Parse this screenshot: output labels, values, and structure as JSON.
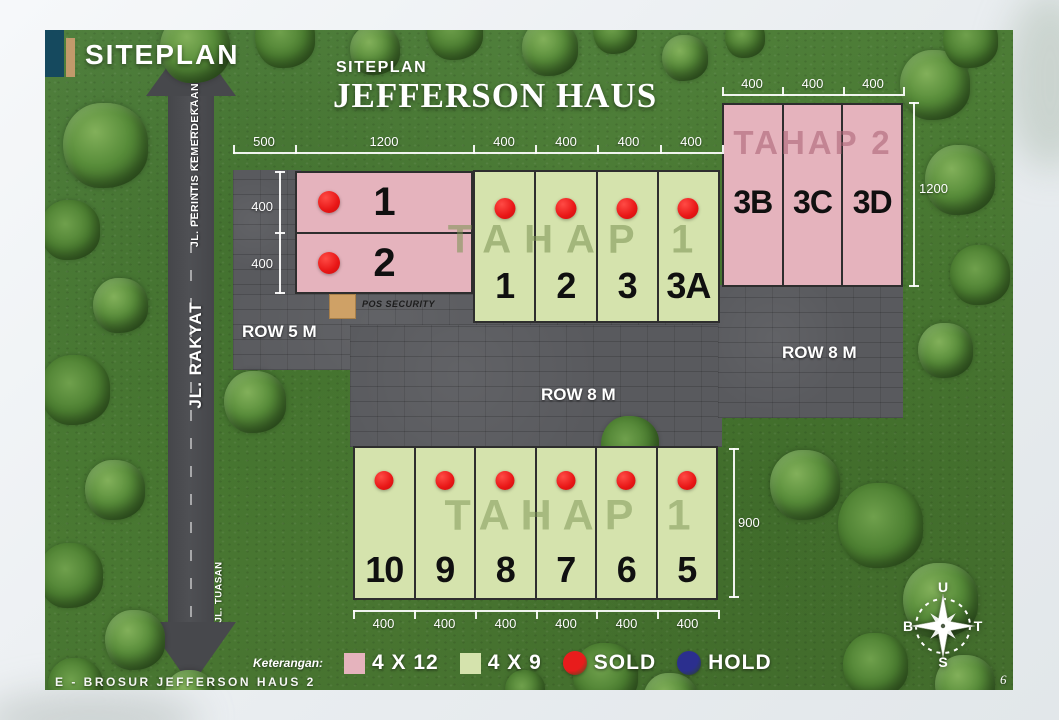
{
  "header": {
    "brand": "SITEPLAN"
  },
  "title": {
    "eyebrow": "SITEPLAN",
    "main": "JEFFERSON HAUS"
  },
  "watermarks": {
    "phase1_north": "TAHAP 1",
    "phase2": "TAHAP 2",
    "phase1_south": "TAHAP 1"
  },
  "streets": {
    "north": "JL. PERINTIS KEMERDEKAAN",
    "west": "JL. RAKYAT",
    "south": "JL. TUASAN"
  },
  "row_labels": {
    "row5": "ROW 5 M",
    "row8_east": "ROW 8 M",
    "row8_center": "ROW 8 M"
  },
  "security_post": {
    "label": "POS SECURITY"
  },
  "blocks": {
    "pink_north": {
      "lots": [
        {
          "label": "1",
          "status": "sold"
        },
        {
          "label": "2",
          "status": "sold"
        }
      ]
    },
    "green_north": {
      "lots": [
        {
          "label": "1",
          "status": "sold"
        },
        {
          "label": "2",
          "status": "sold"
        },
        {
          "label": "3",
          "status": "sold"
        },
        {
          "label": "3A",
          "status": "sold"
        }
      ]
    },
    "pink_east": {
      "lots": [
        {
          "label": "3B",
          "status": "available"
        },
        {
          "label": "3C",
          "status": "available"
        },
        {
          "label": "3D",
          "status": "available"
        }
      ]
    },
    "green_south": {
      "lots": [
        {
          "label": "10",
          "status": "sold"
        },
        {
          "label": "9",
          "status": "sold"
        },
        {
          "label": "8",
          "status": "sold"
        },
        {
          "label": "7",
          "status": "sold"
        },
        {
          "label": "6",
          "status": "sold"
        },
        {
          "label": "5",
          "status": "sold"
        }
      ]
    }
  },
  "dimensions": {
    "north_top": [
      "500",
      "1200",
      "400",
      "400",
      "400",
      "400"
    ],
    "east_top": [
      "400",
      "400",
      "400"
    ],
    "east_right": "1200",
    "west_side": [
      "400",
      "400"
    ],
    "south_right": "900",
    "south_bottom": [
      "400",
      "400",
      "400",
      "400",
      "400",
      "400"
    ]
  },
  "legend": {
    "title": "Keterangan:",
    "items": [
      {
        "type": "swatch",
        "color": "#e5b3bd",
        "label": "4 X 12"
      },
      {
        "type": "swatch",
        "color": "#d5e3ad",
        "label": "4 X 9"
      },
      {
        "type": "dot",
        "color": "#e81c1c",
        "label": "SOLD"
      },
      {
        "type": "dot",
        "color": "#2b2f8e",
        "label": "HOLD"
      }
    ]
  },
  "compass": {
    "north": "U",
    "east": "T",
    "south": "S",
    "west": "B"
  },
  "footer": {
    "note": "E - BROSUR JEFFERSON HAUS 2",
    "page": "6"
  },
  "colors": {
    "pink": "#e5b3bd",
    "green": "#d5e3ad",
    "sold": "#e81c1c",
    "hold": "#2b2f8e"
  }
}
